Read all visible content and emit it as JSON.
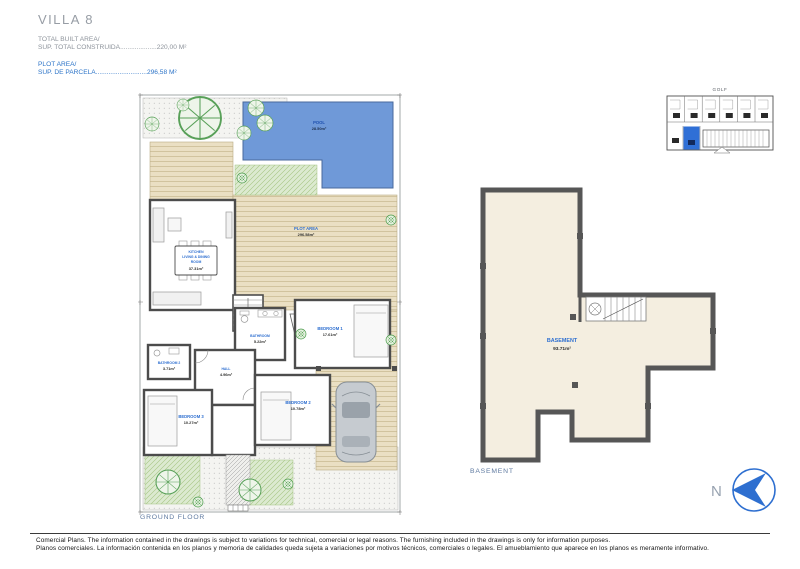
{
  "header": {
    "title": "VILLA 8",
    "built": {
      "label1": "TOTAL BUILT AREA/",
      "label2": "SUP. TOTAL CONSTRUIDA",
      "dots": "....................",
      "value": "220,00 M²"
    },
    "plot": {
      "label1": "PLOT AREA/",
      "label2": "SUP. DE PARCELA",
      "dots": "............................",
      "value": "296,58 M²"
    }
  },
  "site_map": {
    "label": "GOLF"
  },
  "ground_floor": {
    "caption": "GROUND FLOOR",
    "pool": {
      "name": "POOL",
      "area": "28.50m²"
    },
    "plot": {
      "name": "PLOT AREA",
      "area": "296.58m²"
    },
    "kitchen": {
      "line1": "KITCHEN",
      "line2": "LIVING & DINING",
      "line3": "ROOM",
      "area": "37.31m²"
    },
    "bathroom1": {
      "name": "BATHROOM",
      "area": "5.22m²"
    },
    "bedroom1": {
      "name": "BEDROOM 1",
      "area": "17.61m²"
    },
    "bathroom2": {
      "name": "BATHROOM 2",
      "area": "3.71m²"
    },
    "hall": {
      "name": "HALL",
      "area": "4.96m²"
    },
    "bedroom2": {
      "name": "BEDROOM 2",
      "area": "10.78m²"
    },
    "bedroom3": {
      "name": "BEDROOM 3",
      "area": "10.27m²"
    }
  },
  "basement": {
    "caption": "BASEMENT",
    "room": {
      "name": "BASEMENT",
      "area": "93.71m²"
    }
  },
  "north": {
    "label": "N"
  },
  "footer": {
    "line_en": "Comercial Plans. The information contained in the drawings is subject to variations for technical, comercial or legal reasons. The furnishing included in the drawings is only for information purposes.",
    "line_es": "Planos comerciales. La información contenida en los planos y memoria de calidades queda sujeta a variaciones por motivos técnicos, comerciales o legales. El amueblamiento que aparece en los planos es meramente informativo."
  },
  "colors": {
    "accent_blue": "#2e6fd0",
    "pool_blue": "#6f99d8",
    "deck_tan": "#eadfc3",
    "grass_green": "#dcead0",
    "wall_gray": "#4c4c4c",
    "basement_fill": "#f4eee0",
    "header_gray": "#8d939b"
  }
}
